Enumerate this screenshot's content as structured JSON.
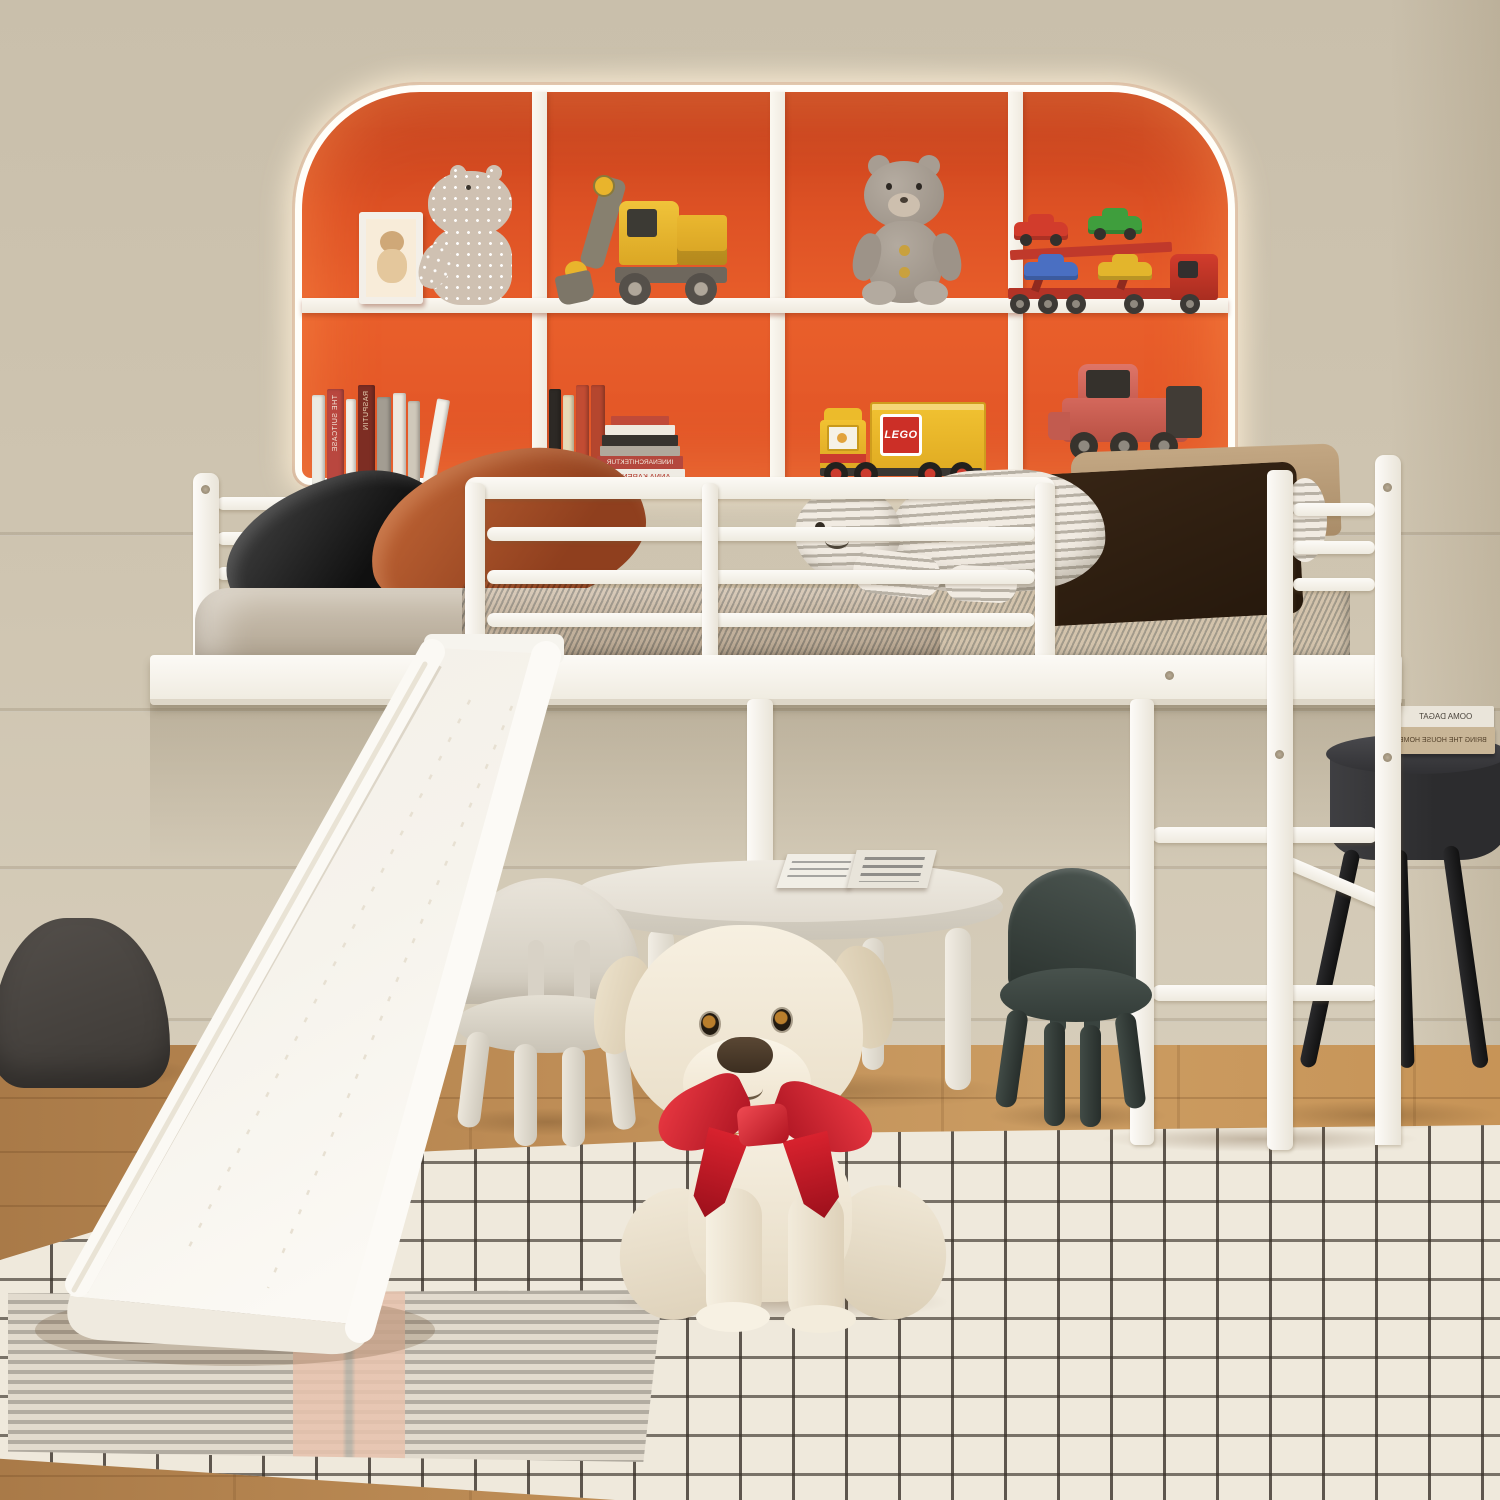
{
  "meta": {
    "domain": "Natural-Image",
    "subject": "Kids' white metal loft bed with slide, arched LED toy shelf, play table and plush toys in a bedroom",
    "canvas_width": 1500,
    "canvas_height": 1500
  },
  "palette": {
    "wall": "#cdc3af",
    "floor_wood": "#bd8c55",
    "rug_base": "#efe9dc",
    "rug_grid": "#413a32",
    "rug_chevron": "#b2aca1",
    "rug_pink_stripe": "#e8c3ae",
    "shelf_orange": "#e25526",
    "shelf_frame_white": "#f7f3eb",
    "led_glow": "#fff6e3",
    "bed_frame_white": "#f7f5f0",
    "mattress_brown": "#8d4e28",
    "blanket_taupe": "#c6bbaa",
    "pillow_black": "#222222",
    "pillow_rust": "#b0572e",
    "pillow_tan": "#b99c79",
    "cushion_brown": "#6f5a41",
    "plush_stripe_gray": "#b8b1a5",
    "chair_white": "#ddd8cd",
    "chair_green": "#39433f",
    "kids_table_white": "#e9e4da",
    "side_table_black": "#323234",
    "dog_cream": "#f2e9d8",
    "dog_bow_red": "#d8222e",
    "pouf_gray": "#8b8784",
    "toy_yellow": "#e9b42c",
    "toy_red": "#c0392b",
    "toy_green": "#3f9e3d",
    "toy_blue": "#4a6fc2",
    "toy_pink": "#d4685c"
  },
  "bookcase": {
    "style": "arched cubby wall shelf with white LED backlight",
    "rows": 2,
    "columns": 4,
    "top_row_items": [
      "framed bear print",
      "polka-dot hippo plush",
      "wooden excavator toy",
      "gray teddy bear",
      "car-carrier truck with four toy cars"
    ],
    "bottom_row_items": [
      "row of assorted books",
      "standing and stacked books",
      "yellow LEGO truck",
      "pink toy truck"
    ]
  },
  "books": {
    "note": "book spine titles appear mirror-flipped in the photo",
    "spine_titles": {
      "suitcase": "THE SUITCASE",
      "rasputin": "RASPUTIN",
      "innenarchitektur": "INNENARCHITEKTUR",
      "anna_karenina": "ANNA KARENINA"
    },
    "side_table_titles": {
      "top": "OOMA DAGAT",
      "bottom": "BRING THE HOUSE HOME"
    }
  },
  "lego": {
    "logo": "LEGO"
  },
  "bed": {
    "type": "white metal loft bed",
    "guardrail": "full-length front guardrail",
    "accessories": [
      "white slide on the left",
      "ladder on the right"
    ],
    "bedding": [
      "brown textured mattress",
      "taupe blanket",
      "black pillow",
      "rust-orange pillow",
      "tan pillow",
      "brown quilted cushion",
      "striped polar-bear plush",
      "striped plush ball"
    ]
  },
  "under_bed": {
    "play_table": {
      "shape": "round",
      "color": "white",
      "on_top": "open picture book"
    },
    "chairs": [
      "white kids chair",
      "dark green kids chair"
    ],
    "plush_dog": {
      "color": "cream",
      "accessory": "red ribbon bow"
    }
  },
  "side_table": {
    "color": "black",
    "shape": "round",
    "books_on_top": 2
  },
  "pouf": {
    "color": "gray",
    "style": "quilted"
  },
  "rug": {
    "pattern": "cream windowpane check",
    "accent": "gray chevron band with blush stripes"
  },
  "floor": "warm wood planks",
  "lighting": "warm LED glow around the shelf arch"
}
